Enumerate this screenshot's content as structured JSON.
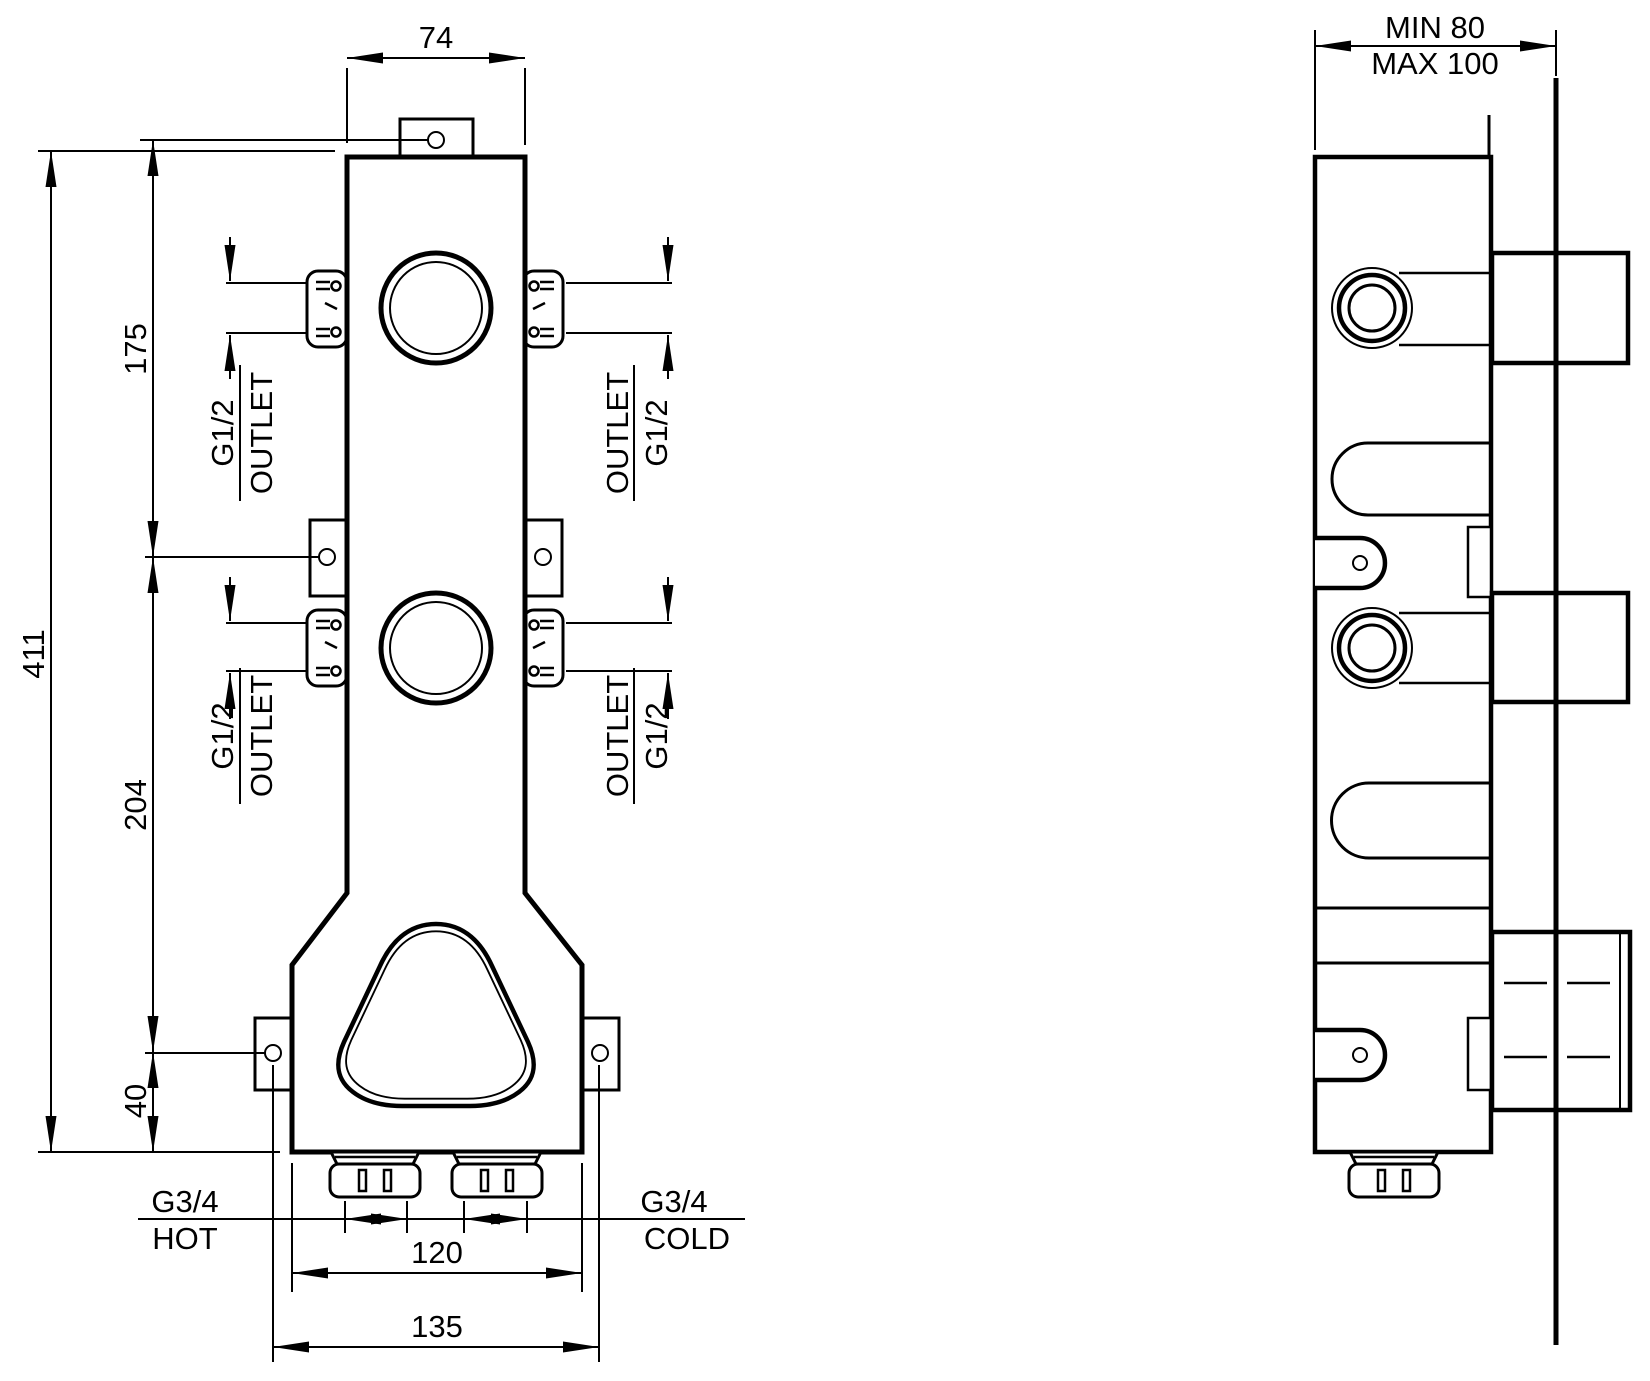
{
  "front": {
    "dims": {
      "top_width": "74",
      "total_height": "411",
      "hole_spacing_top": "175",
      "hole_spacing_mid": "204",
      "bottom_offset": "40",
      "body_width": "120",
      "mount_span": "135"
    },
    "outlet": {
      "size": "G1/2",
      "label": "OUTLET"
    },
    "inlet": {
      "size": "G3/4",
      "hot": "HOT",
      "cold": "COLD"
    }
  },
  "side": {
    "depth_min": "MIN 80",
    "depth_max": "MAX 100"
  },
  "colors": {
    "line": "#000000",
    "background": "#ffffff"
  }
}
